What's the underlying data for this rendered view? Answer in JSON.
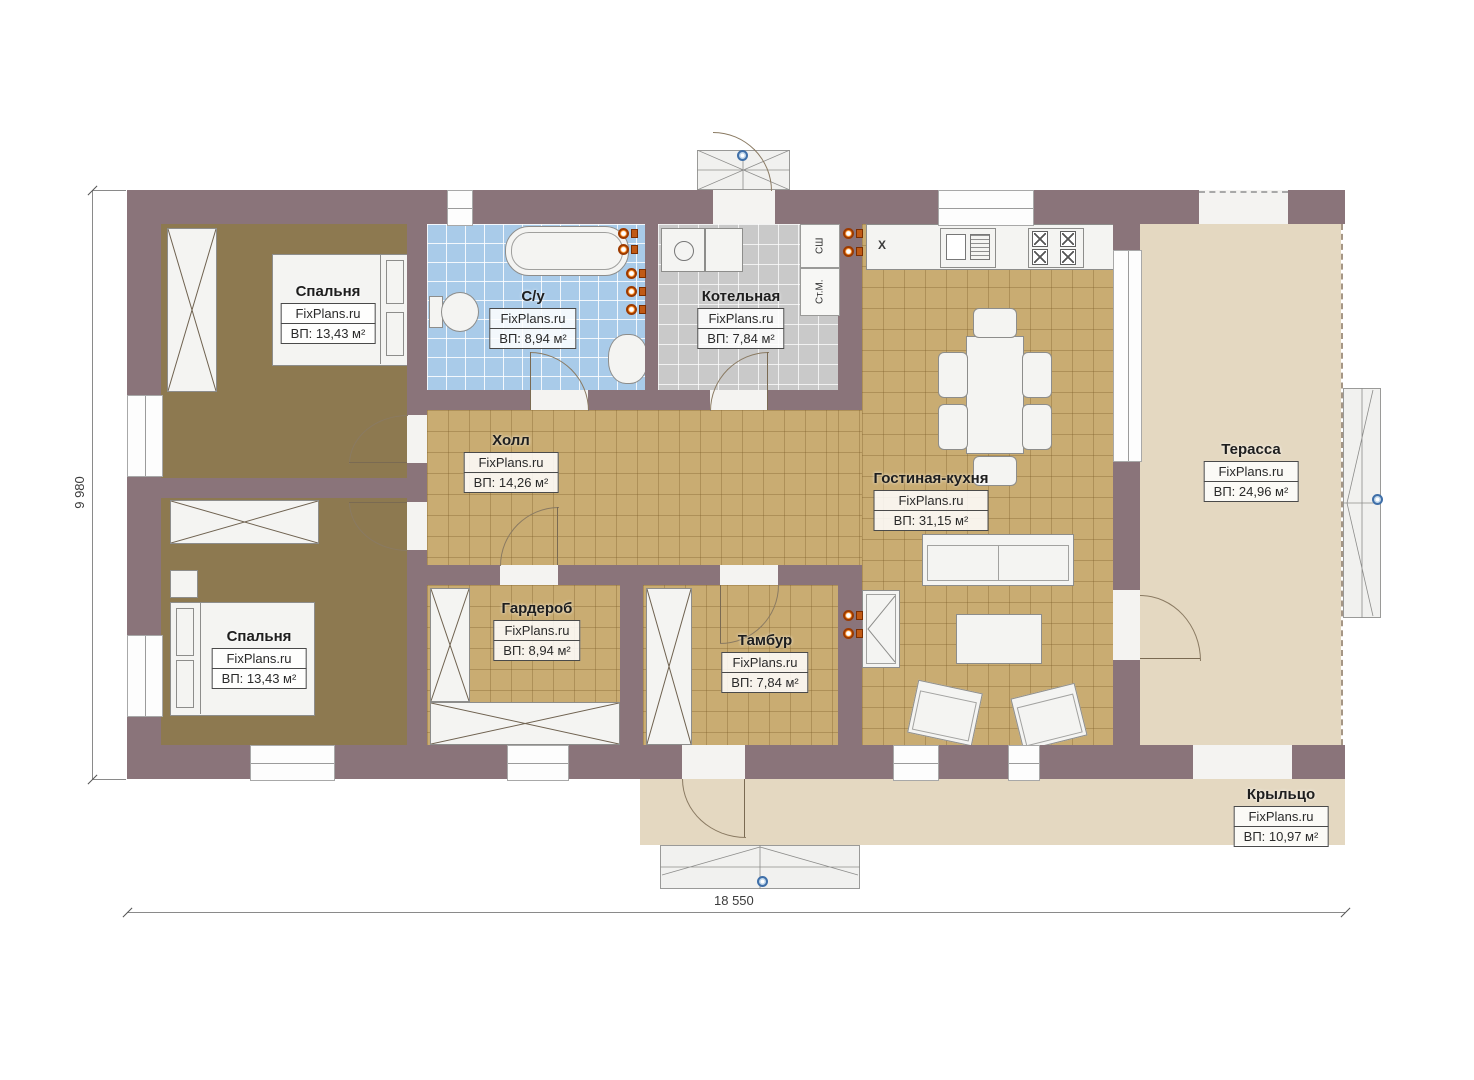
{
  "plan": {
    "dim_width_label": "18 550",
    "dim_height_label": "9 980",
    "kitchen_marker": "X",
    "boiler_labels": {
      "sh": "СШ",
      "stm": "Ст.М."
    }
  },
  "rooms": [
    {
      "id": "bedroom-top",
      "name": "Спальня",
      "watermark": "FixPlans.ru",
      "area": "ВП: 13,43 м²"
    },
    {
      "id": "bathroom",
      "name": "С/у",
      "watermark": "FixPlans.ru",
      "area": "ВП: 8,94 м²"
    },
    {
      "id": "boiler",
      "name": "Котельная",
      "watermark": "FixPlans.ru",
      "area": "ВП: 7,84 м²"
    },
    {
      "id": "hall",
      "name": "Холл",
      "watermark": "FixPlans.ru",
      "area": "ВП: 14,26 м²"
    },
    {
      "id": "living-kitchen",
      "name": "Гостиная-кухня",
      "watermark": "FixPlans.ru",
      "area": "ВП: 31,15 м²"
    },
    {
      "id": "terrace",
      "name": "Терасса",
      "watermark": "FixPlans.ru",
      "area": "ВП: 24,96 м²"
    },
    {
      "id": "bedroom-bottom",
      "name": "Спальня",
      "watermark": "FixPlans.ru",
      "area": "ВП: 13,43 м²"
    },
    {
      "id": "wardrobe",
      "name": "Гардероб",
      "watermark": "FixPlans.ru",
      "area": "ВП: 8,94 м²"
    },
    {
      "id": "vestibule",
      "name": "Тамбур",
      "watermark": "FixPlans.ru",
      "area": "ВП: 7,84 м²"
    },
    {
      "id": "porch",
      "name": "Крыльцо",
      "watermark": "FixPlans.ru",
      "area": "ВП: 10,97 м²"
    }
  ]
}
